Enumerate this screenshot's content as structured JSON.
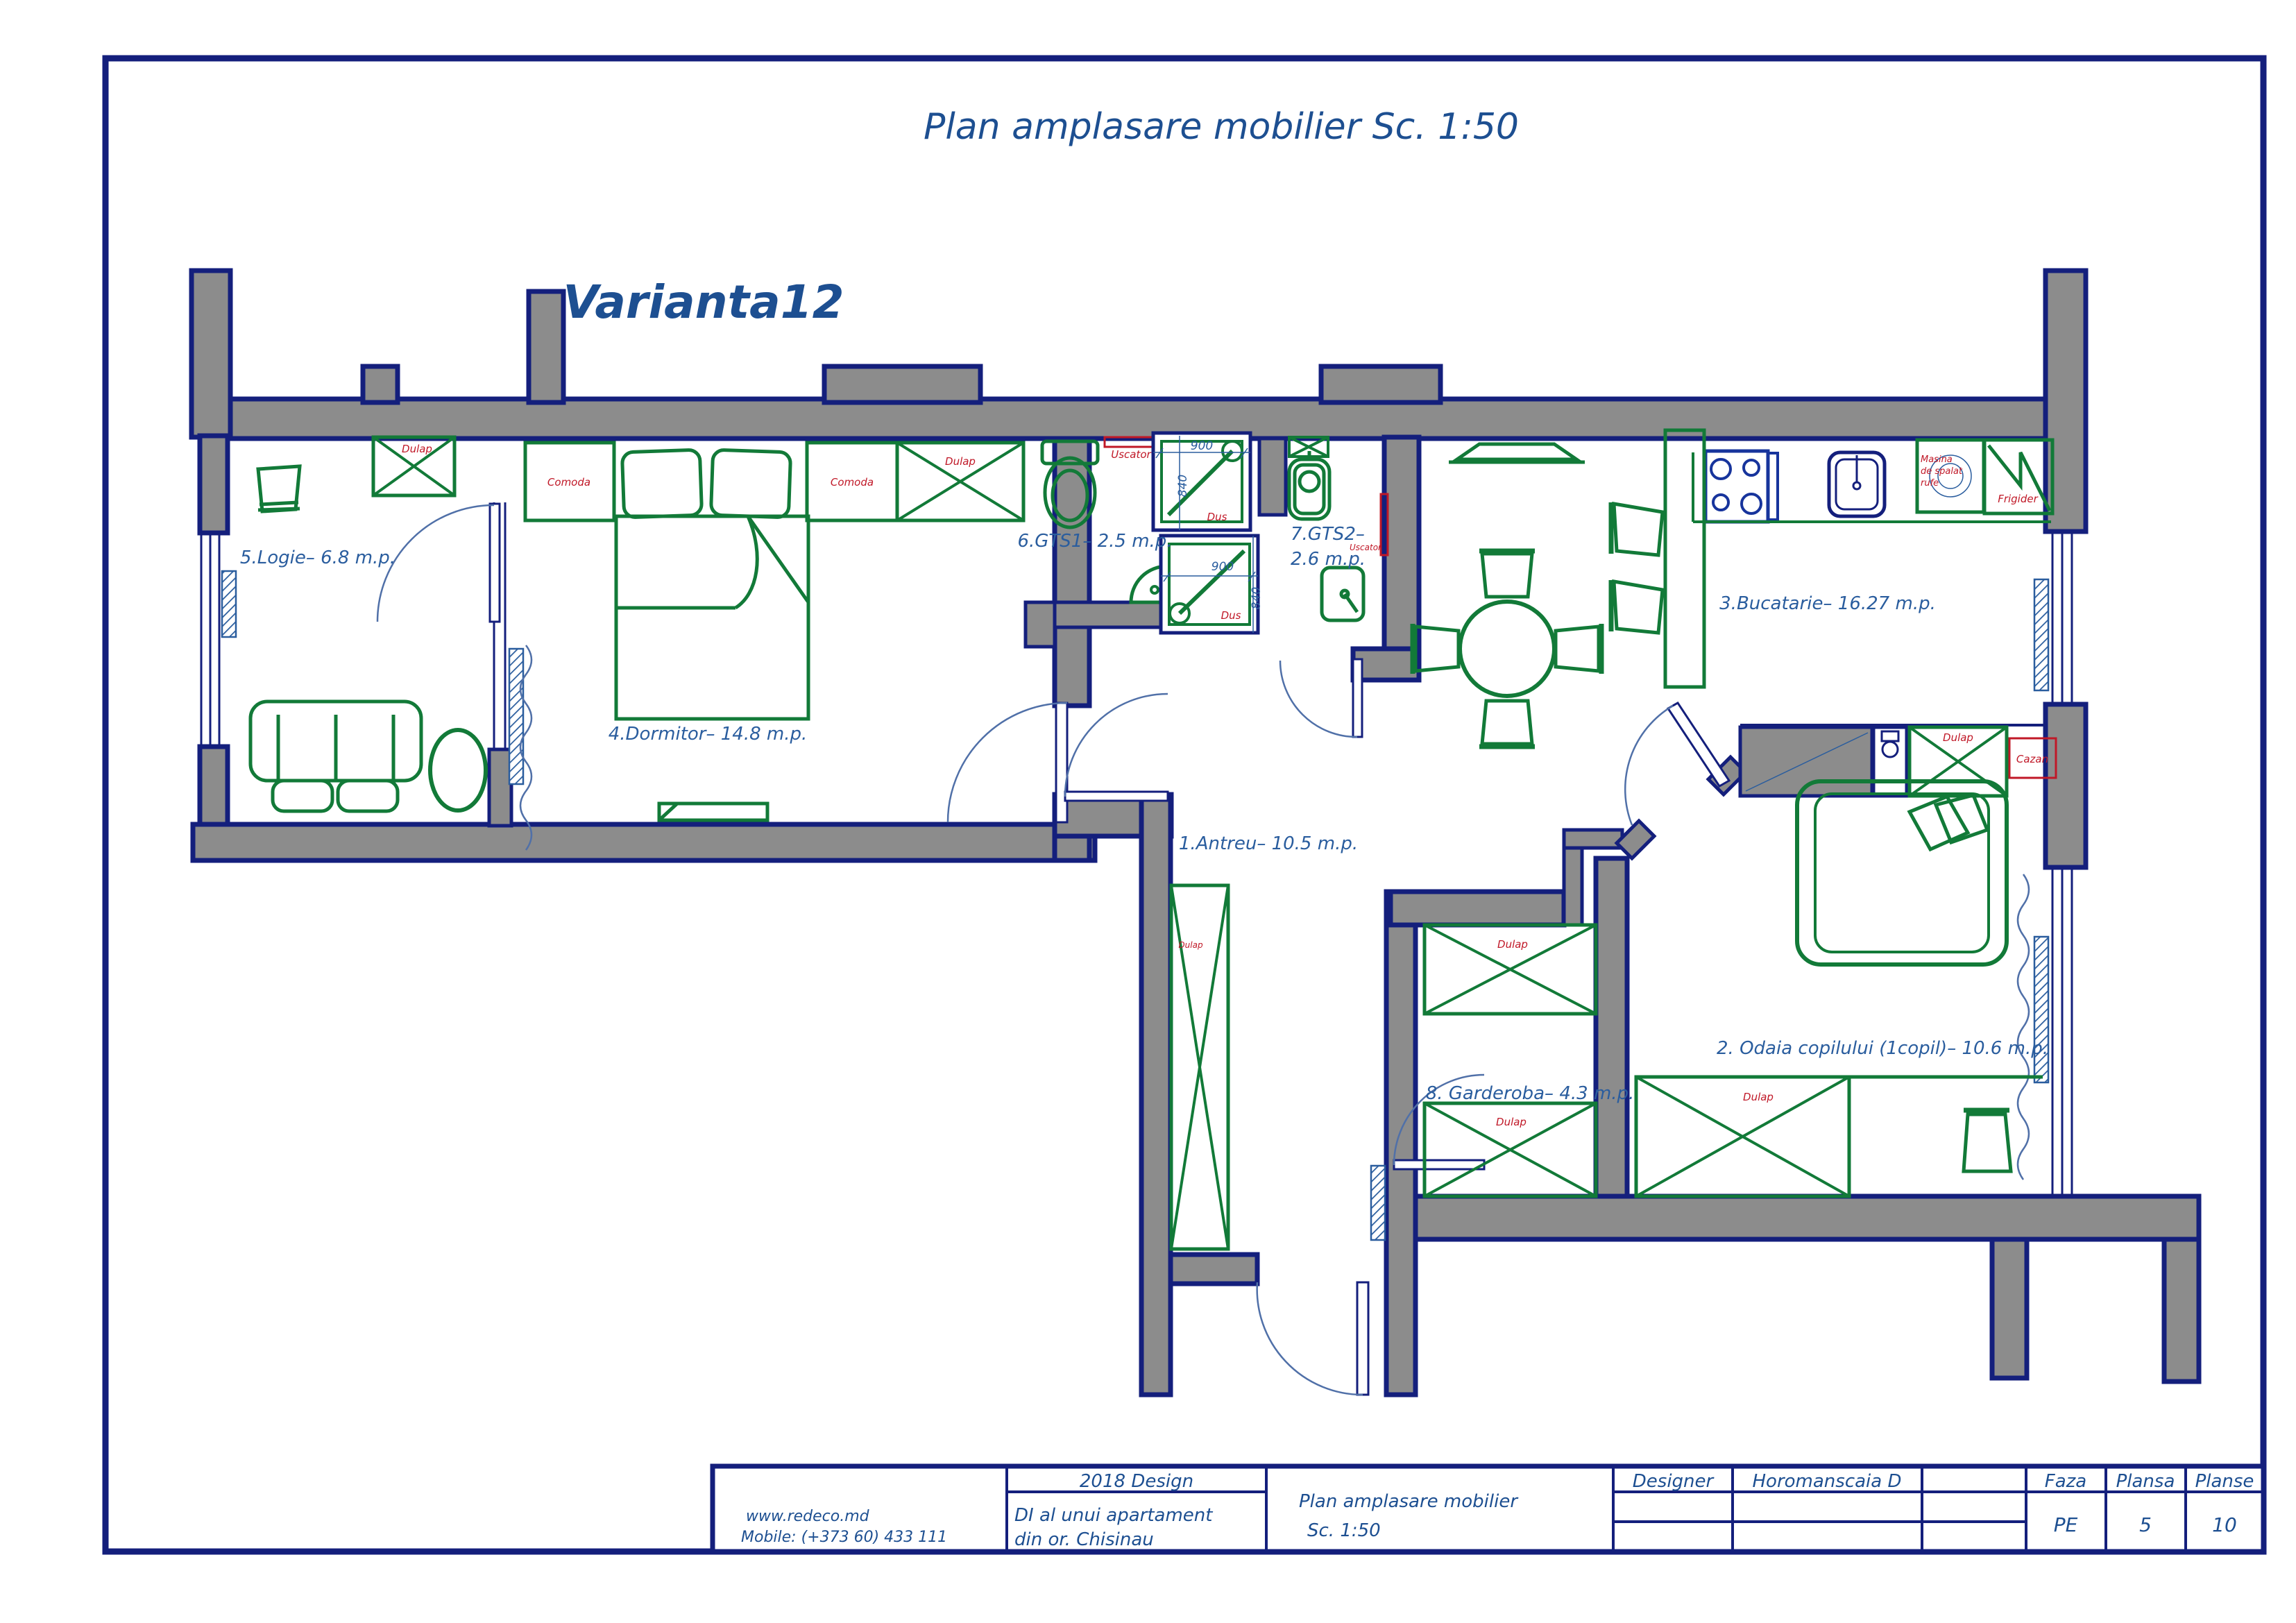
{
  "page": {
    "title": "Plan amplasare mobilier Sc. 1:50",
    "variant": "Varianta12"
  },
  "rooms": {
    "antreu": "1.Antreu– 10.5 m.p.",
    "odaia": "2. Odaia copilului (1copil)– 10.6 m.p.",
    "bucatarie": "3.Bucatarie– 16.27 m.p.",
    "dormitor": "4.Dormitor– 14.8 m.p.",
    "logie": "5.Logie– 6.8 m.p.",
    "gts1": "6.GTS1– 2.5 m.p.",
    "gts2_line1": "7.GTS2–",
    "gts2_line2": "2.6 m.p.",
    "garderoba": "8. Garderoba– 4.3 m.p."
  },
  "furniture": {
    "dulap": "Dulap",
    "comoda": "Comoda",
    "uscator": "Uscator",
    "dus": "Dus",
    "cazan": "Cazan",
    "frigider": "Frigider",
    "masina_line1": "Masina",
    "masina_line2": "de spalat",
    "masina_line3": "rufe"
  },
  "dimensions": {
    "d900": "900",
    "d840": "840"
  },
  "titleblock": {
    "website": "www.redeco.md",
    "mobile": "Mobile: (+373 60) 433 111",
    "year_design": "2018 Design",
    "project_line1": "DI al unui apartament",
    "project_line2": "din or. Chisinau",
    "drawing_line1": "Plan amplasare mobilier",
    "drawing_line2": "Sc. 1:50",
    "designer_label": "Designer",
    "designer_name": "Horomanscaia D",
    "faza_label": "Faza",
    "plansa_label": "Plansa",
    "planse_label": "Planse",
    "faza_value": "PE",
    "plansa_value": "5",
    "planse_value": "10"
  },
  "colors": {
    "wall_stroke": "#141f7c",
    "wall_fill": "#8c8c8c",
    "furniture_green": "#127a38",
    "label_red": "#c01827",
    "label_blue": "#2a5d9e",
    "title_blue": "#1d4f91"
  }
}
